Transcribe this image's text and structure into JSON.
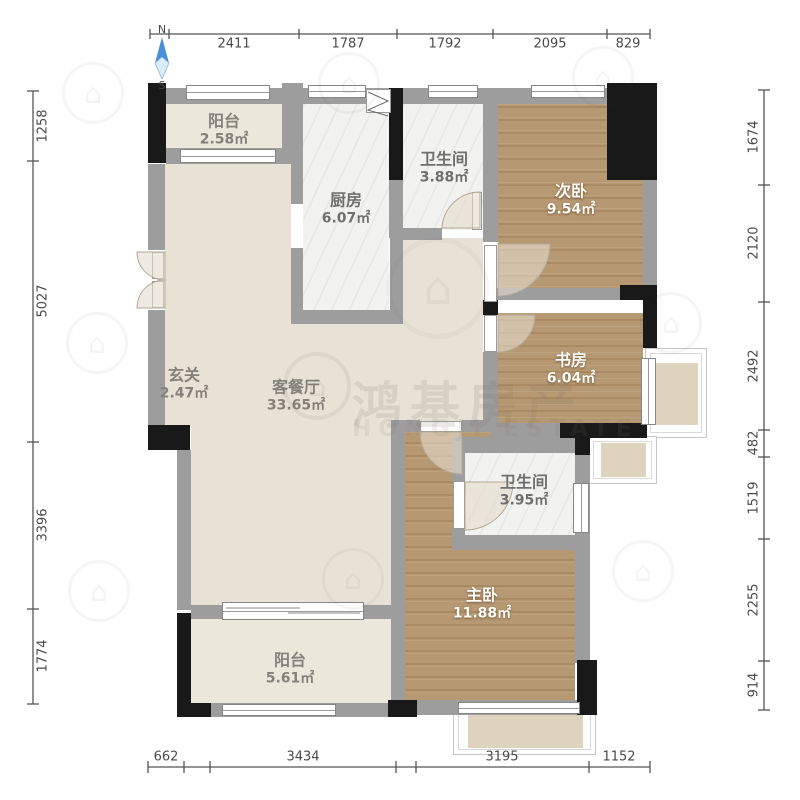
{
  "compass": {
    "north_label": "N",
    "south_label": "S"
  },
  "watermark": {
    "brand_cn": "鸿基房产",
    "brand_en": "HONGJI ESTATE",
    "logo_glyph": "⌂"
  },
  "rooms": {
    "balcony_north": {
      "name": "阳台",
      "area": "2.58㎡"
    },
    "kitchen": {
      "name": "厨房",
      "area": "6.07㎡"
    },
    "bath_north": {
      "name": "卫生间",
      "area": "3.88㎡"
    },
    "bedroom_second": {
      "name": "次卧",
      "area": "9.54㎡"
    },
    "study": {
      "name": "书房",
      "area": "6.04㎡"
    },
    "entry": {
      "name": "玄关",
      "area": "2.47㎡"
    },
    "living_dining": {
      "name": "客餐厅",
      "area": "33.65㎡"
    },
    "bath_south": {
      "name": "卫生间",
      "area": "3.95㎡"
    },
    "bedroom_master": {
      "name": "主卧",
      "area": "11.88㎡"
    },
    "balcony_south": {
      "name": "阳台",
      "area": "5.61㎡"
    }
  },
  "dimensions": {
    "top": [
      "2411",
      "1787",
      "1792",
      "2095",
      "829"
    ],
    "left": [
      "1258",
      "5027",
      "3396",
      "1774"
    ],
    "right": [
      "1674",
      "2120",
      "2492",
      "482",
      "1519",
      "2255",
      "914"
    ],
    "bottom": [
      "662",
      "3434",
      "3195",
      "1152"
    ]
  },
  "colors": {
    "wall_gray": "#9d9d9d",
    "wall_black": "#191919",
    "wood_floor": "#b3946f",
    "beige_floor": "#e8e2d6",
    "marble_floor": "#f2f2f0",
    "north_arrow": "#4a90d9"
  }
}
